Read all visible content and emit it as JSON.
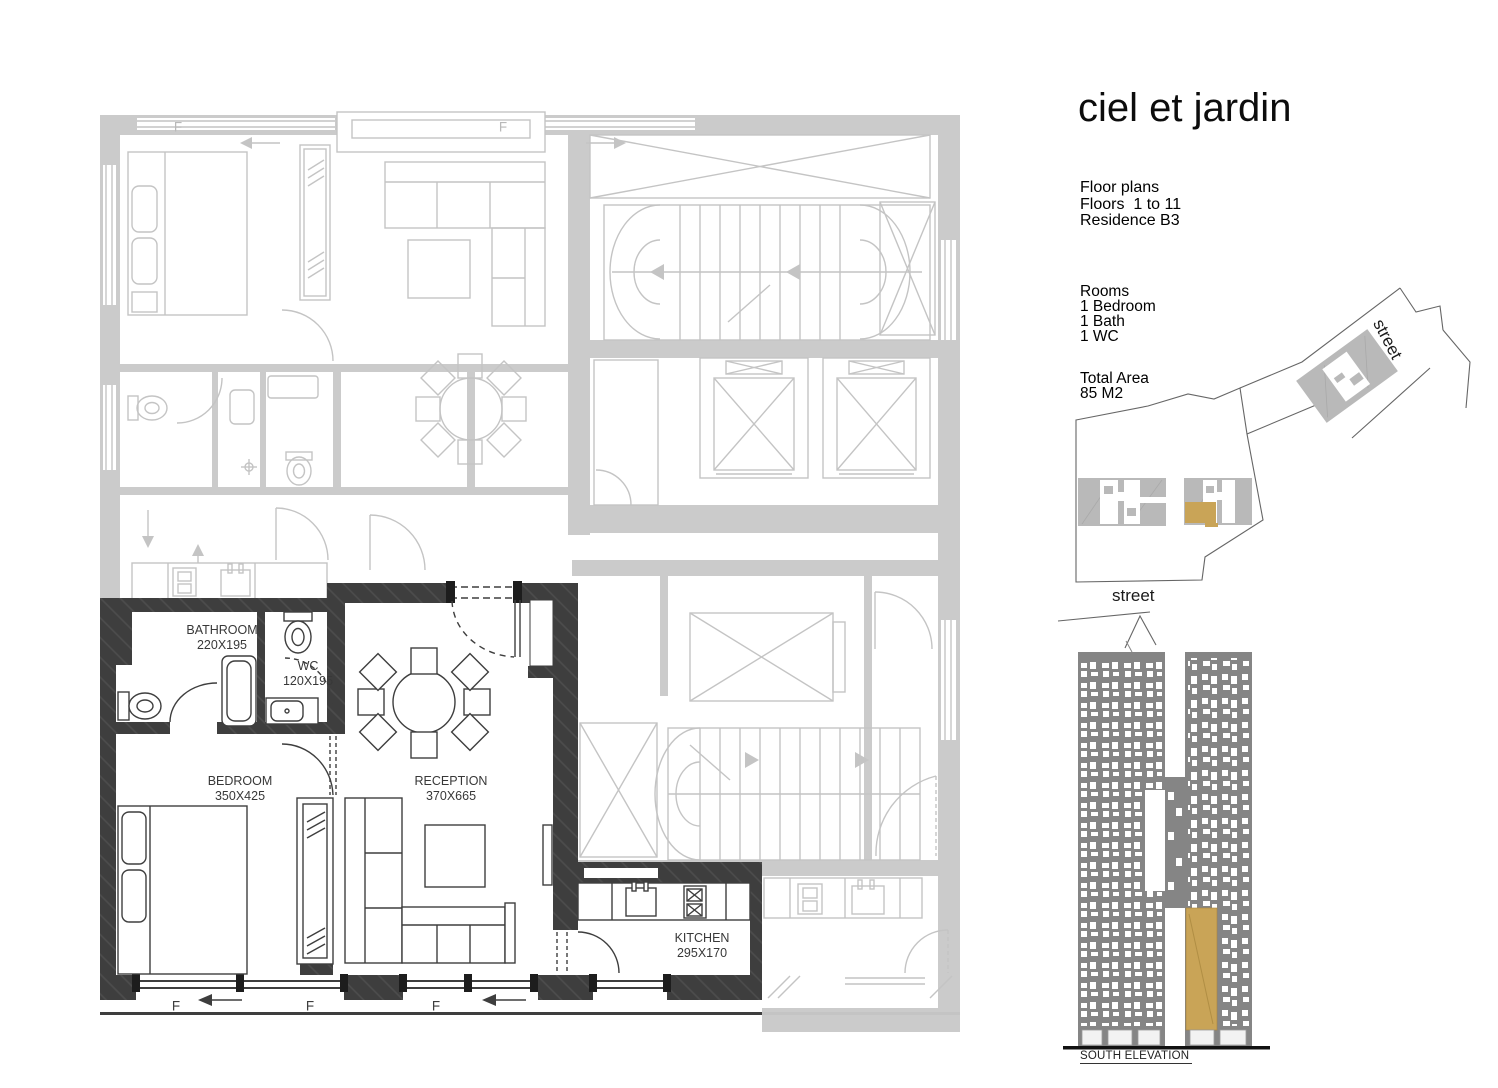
{
  "panel": {
    "title": "ciel et jardin",
    "info_lines": [
      "Floor plans",
      "Floors  1 to 11",
      "Residence B3"
    ],
    "rooms_lines": [
      "Rooms",
      "1 Bedroom",
      "1 Bath",
      "1 WC"
    ],
    "area_lines": [
      "Total Area",
      "85 M2"
    ],
    "street_upper": "street",
    "street_lower": "street",
    "elevation_caption": "SOUTH ELEVATION"
  },
  "plan": {
    "rooms": [
      {
        "name": "BATHROOM",
        "dims": "220X195"
      },
      {
        "name": "WC",
        "dims": "120X195"
      },
      {
        "name": "BEDROOM",
        "dims": "350X425"
      },
      {
        "name": "RECEPTION",
        "dims": "370X665"
      },
      {
        "name": "KITCHEN",
        "dims": "295X170"
      }
    ],
    "window_marks": [
      "F",
      "F",
      "F",
      "F",
      "F"
    ]
  },
  "colors": {
    "highlight_gold": "#c9a457",
    "dark_wall": "#3e3e3e",
    "plan_gray": "#c6c6c6",
    "elevation_gray": "#858585",
    "site_block_gray": "#b9b9b9"
  }
}
